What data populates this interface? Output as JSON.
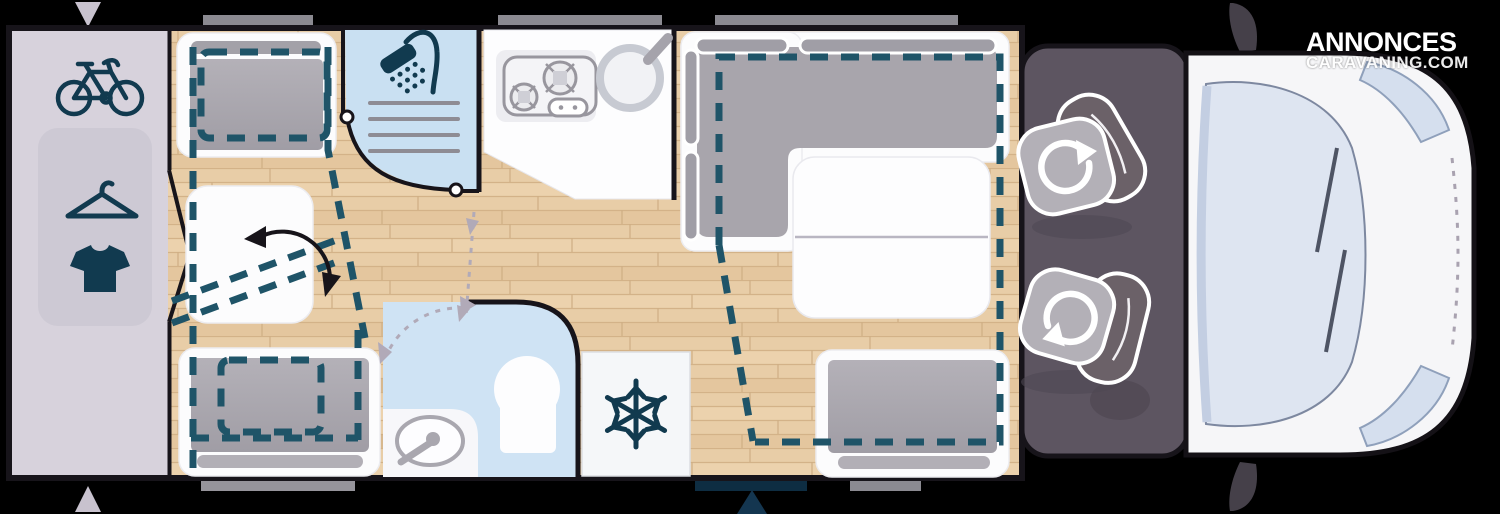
{
  "watermark": {
    "line1": "ANNONCES",
    "line2": "CARAVANING.COM"
  },
  "colors": {
    "background": "#000000",
    "garage": "#d7d2dc",
    "garage_inner": "#cdc9d4",
    "shower_blue": "#c9e0f2",
    "bath_blue": "#cfe3f4",
    "cushion_gray": "#a8a5ac",
    "cab_dark": "#5d5561",
    "accent_teal": "#1f5468",
    "icon_navy": "#113a4f",
    "door_navy": "#0e2d42",
    "cab_body": "#f6f6f8",
    "windshield": "#dee5f1",
    "floor_wood": "#e8cda7",
    "window_bar_gray": "#8b8a91",
    "marker_lavender": "#c8c2ce"
  },
  "icons": {
    "bicycle": "bike storage in garage",
    "clothes_hanger": "wardrobe",
    "tshirt": "clothes storage",
    "shower_head": "shower cubicle",
    "stove": "2-burner hob",
    "sink_round": "kitchen sink",
    "snowflake": "refrigerator",
    "rotate_arrow": "swivel cab seat",
    "pivot_arrow": "fold-down bed rotation",
    "door_swing_arrows": "door swing paths"
  }
}
